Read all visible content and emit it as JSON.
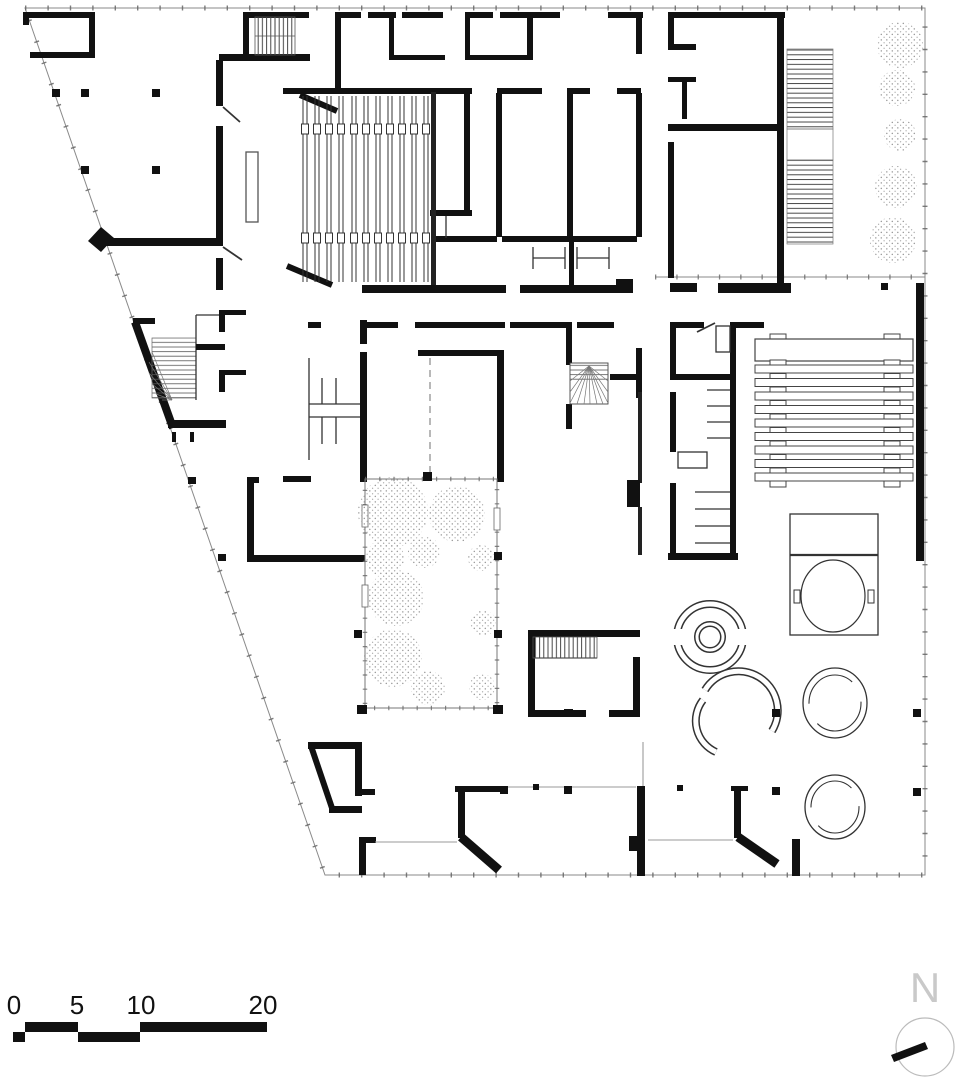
{
  "plan": {
    "kind": "architectural-floor-plan",
    "features": [
      "exterior-boundary",
      "structural-walls",
      "auditorium-seating",
      "stage",
      "northwest-stair",
      "left-winder-stair",
      "central-winder-stair",
      "south-stair",
      "exterior-step-ramp",
      "tree-row",
      "courtyard-garden",
      "toilet-block",
      "shelving-room",
      "long-bench-rows",
      "round-sofa-booth",
      "curved-benches",
      "round-pools",
      "square-spa-with-tub",
      "structural-columns"
    ]
  },
  "scale_bar": {
    "labels": [
      "0",
      "5",
      "10",
      "20"
    ]
  },
  "north_indicator": {
    "label": "N"
  },
  "colors": {
    "wall": "#111111",
    "thin_line": "#333333",
    "boundary": "#8a8a8a",
    "tree_dot": "#9a9a9a",
    "north_letter": "#c9c9c9",
    "background": "#ffffff"
  }
}
